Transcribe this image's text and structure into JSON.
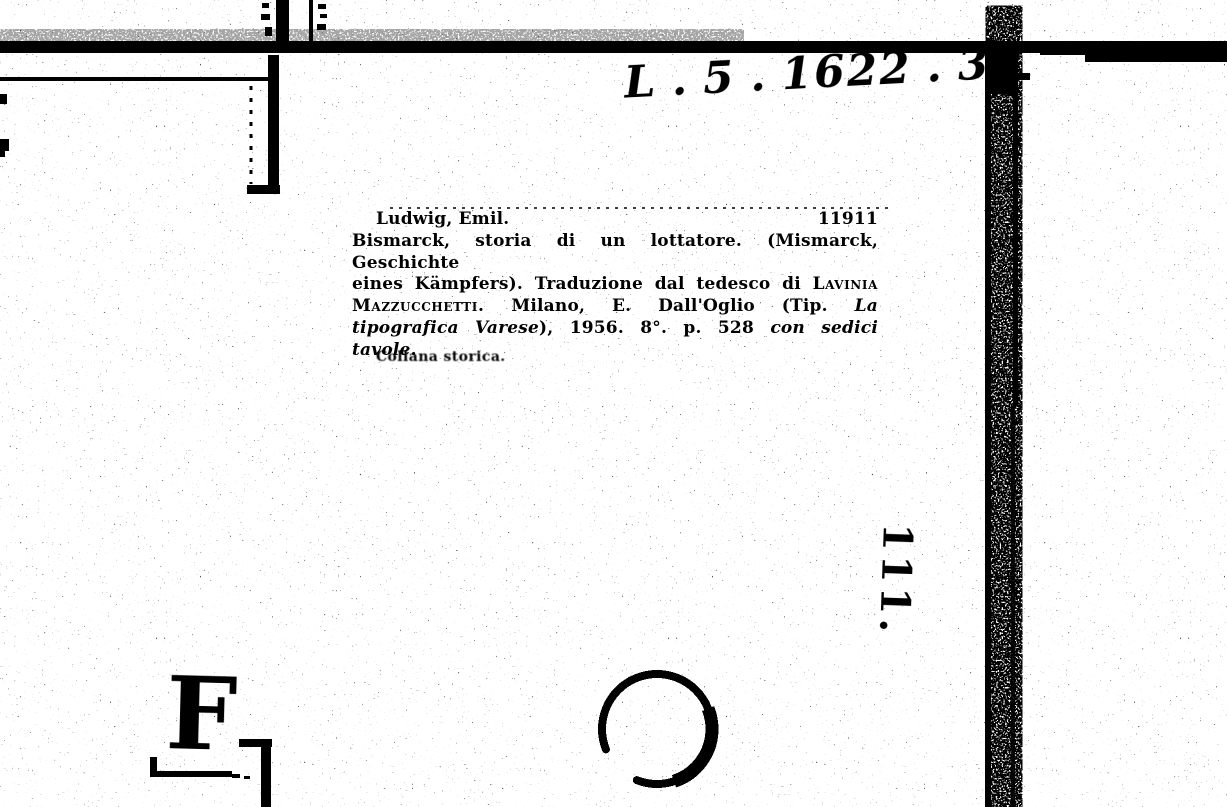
{
  "scan": {
    "paper_color": "#ffffff",
    "ink_color": "#000000",
    "shelfmark": "L . 5 . 1622 . 3",
    "margin_number": "111.",
    "stamp_letter": "F",
    "card": {
      "author": "Ludwig, Emil.",
      "entry_number": "11911",
      "line2": "Bismarck, storia di un lottatore. (Mismarck, Geschichte",
      "line3_text": "eines Kämpfers). Traduzione dal tedesco di ",
      "line3_smallcaps": "Lavinia",
      "line4_smallcaps": "Mazzucchetti.",
      "line4_text": " Milano, E. Dall'Oglio (Tip. ",
      "line4_italic": "La",
      "line5_italic1": "tipografica Varese",
      "line5_text": "), 1956. 8°. p. 528 ",
      "line5_italic2": "con sedici",
      "line6": "tavole.",
      "note": "Collana storica."
    }
  }
}
